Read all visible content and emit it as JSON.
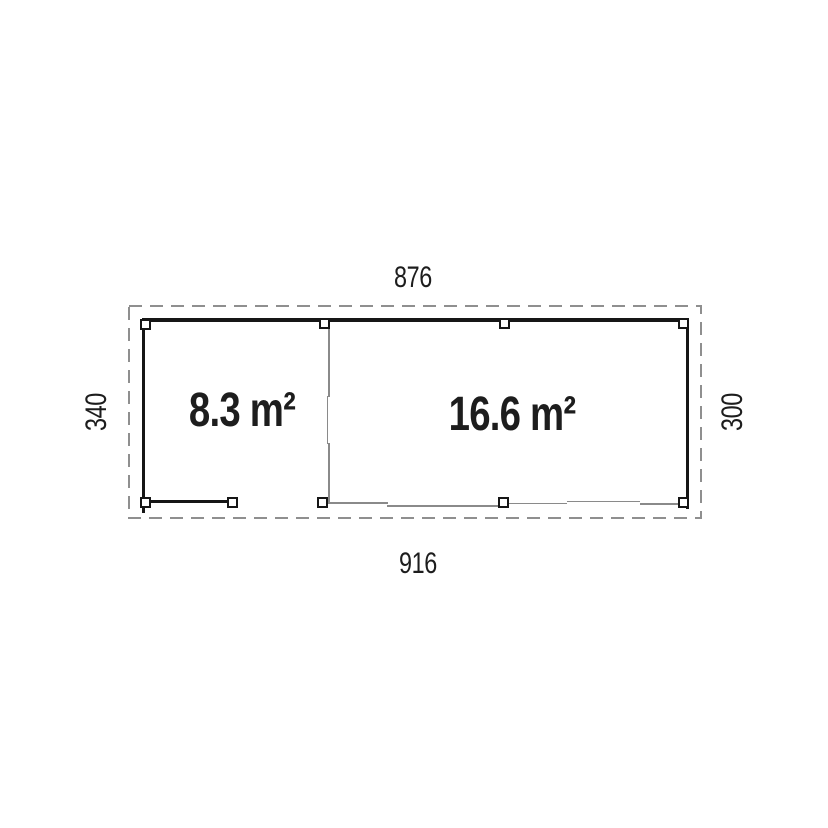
{
  "plan": {
    "type": "floor-plan",
    "dimensions": {
      "top": "876",
      "bottom": "916",
      "left": "340",
      "right": "300"
    },
    "rooms": [
      {
        "area_label": "8.3 m²"
      },
      {
        "area_label": "16.6 m²"
      }
    ]
  },
  "colors": {
    "background": "#ffffff",
    "wall": "#161616",
    "thin_line": "#8a8a8a",
    "dash_outline": "#8f8f8f",
    "text": "#1d1d1d"
  }
}
